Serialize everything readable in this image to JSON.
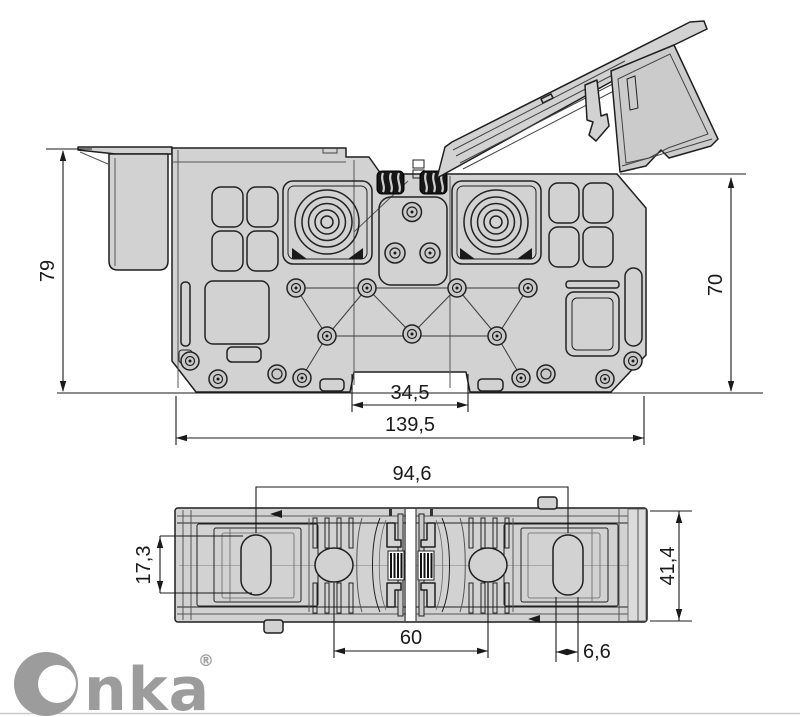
{
  "side_view": {
    "dimensions": {
      "height_left": "79",
      "height_right": "70",
      "rail_notch_width": "34,5",
      "overall_width": "139,5"
    }
  },
  "plan_view": {
    "dimensions": {
      "slot_center_distance": "94,6",
      "slot_height": "17,3",
      "overall_depth": "41,4",
      "screw_center_distance": "60",
      "slot_width": "6,6"
    }
  },
  "branding": {
    "name": "Onka",
    "wordmark_tail": "nka",
    "registered_mark": "®",
    "logo_color": "#9c9c9c"
  },
  "colors": {
    "background": "#ffffff",
    "body_fill": "#d2d2d2",
    "panel_fill": "#c9c9c9",
    "end_cap_fill": "#dcdcdc",
    "outline": "#1f1f1f",
    "dimension_line": "#1a1a1a",
    "hatch_dark": "#161616"
  }
}
